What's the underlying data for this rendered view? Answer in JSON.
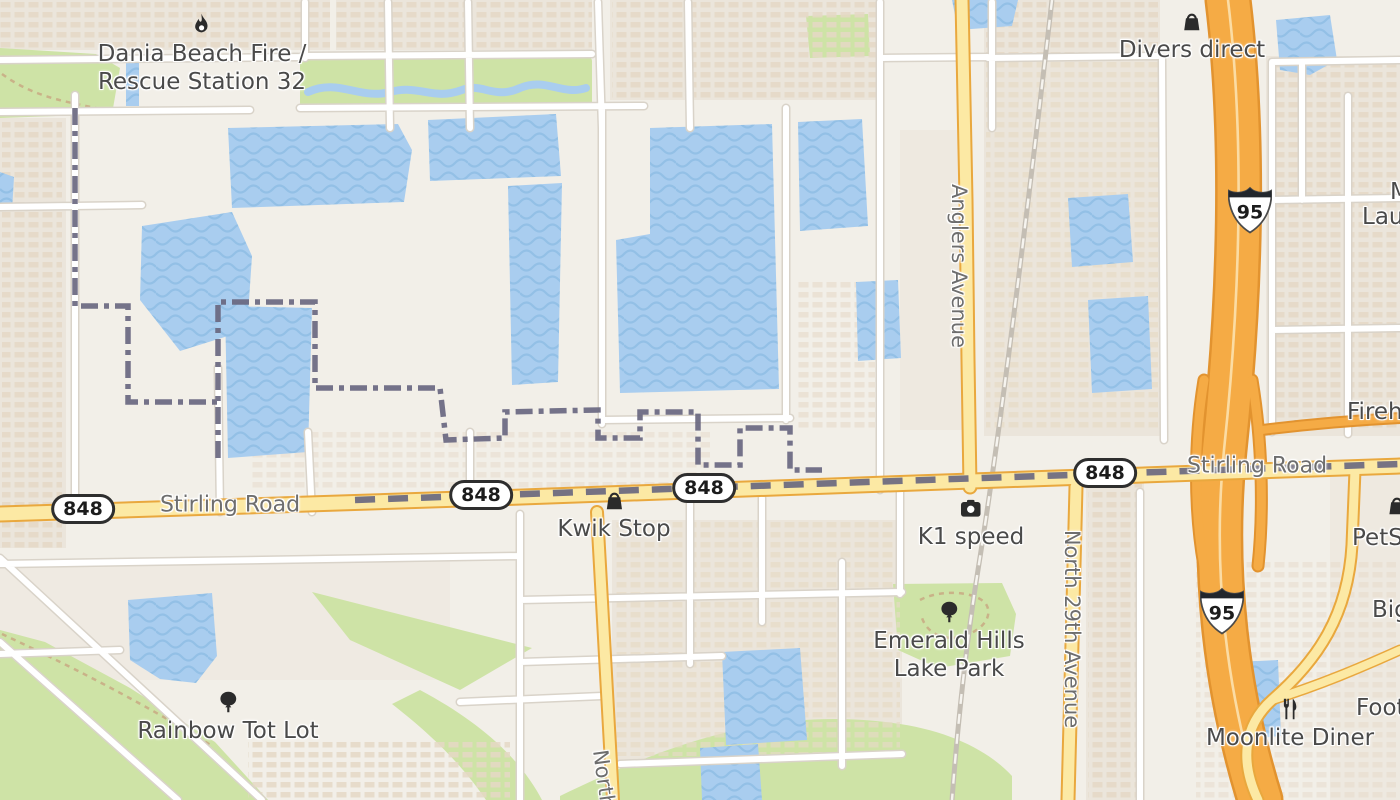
{
  "pois": [
    {
      "id": "dania-fire",
      "line1": "Dania Beach Fire /",
      "line2": "Rescue Station 32",
      "icon": "fire-icon"
    },
    {
      "id": "divers-direct",
      "line1": "Divers direct",
      "icon": "shopping-bag-icon"
    },
    {
      "id": "kwik-stop",
      "line1": "Kwik Stop",
      "icon": "shopping-bag-icon"
    },
    {
      "id": "k1-speed",
      "line1": "K1 speed",
      "icon": "camera-icon"
    },
    {
      "id": "emerald-hills-lake-park",
      "line1": "Emerald Hills",
      "line2": "Lake Park",
      "icon": "tree-icon"
    },
    {
      "id": "rainbow-tot-lot",
      "line1": "Rainbow Tot Lot",
      "icon": "tree-icon"
    },
    {
      "id": "moonlite-diner",
      "line1": "Moonlite Diner",
      "icon": "dining-icon"
    },
    {
      "id": "petsmart-partial",
      "line1": "PetSm",
      "icon": "shopping-bag-icon"
    },
    {
      "id": "firehouse-partial",
      "line1": "Firehou"
    },
    {
      "id": "big-partial",
      "line1": "Big"
    },
    {
      "id": "foot-partial",
      "line1": "Foot"
    },
    {
      "id": "m-lau-partial",
      "line1": "M",
      "line2": "Lau"
    }
  ],
  "road_labels": [
    {
      "id": "stirling-left",
      "text": "Stirling Road"
    },
    {
      "id": "stirling-right",
      "text": "Stirling Road"
    },
    {
      "id": "anglers-avenue",
      "text": "Anglers Avenue"
    },
    {
      "id": "north-29th-avenue",
      "text": "North 29th Avenue"
    },
    {
      "id": "north-partial",
      "text": "North"
    }
  ],
  "route_shields": [
    {
      "id": "sr848-a",
      "system": "state",
      "number": "848"
    },
    {
      "id": "sr848-b",
      "system": "state",
      "number": "848"
    },
    {
      "id": "sr848-c",
      "system": "state",
      "number": "848"
    },
    {
      "id": "sr848-d",
      "system": "state",
      "number": "848"
    },
    {
      "id": "i95-north",
      "system": "interstate",
      "number": "95"
    },
    {
      "id": "i95-south",
      "system": "interstate",
      "number": "95"
    }
  ],
  "colors": {
    "land": "#f2efe8",
    "water": "#a9cdef",
    "water_wave": "#93c0e6",
    "park": "#cee3a6",
    "road_major_fill": "#fce9a4",
    "road_major_casing": "#e9a83e",
    "highway_fill": "#f5ab45",
    "highway_casing": "#e2932f",
    "road_minor_fill": "#ffffff",
    "road_minor_casing": "#d9d3c9",
    "boundary": "#6a6880",
    "building": "#e5d9c6",
    "poi_text": "#4a4a4a",
    "road_text": "#6e6e6e",
    "railway": "#c4beb4"
  }
}
